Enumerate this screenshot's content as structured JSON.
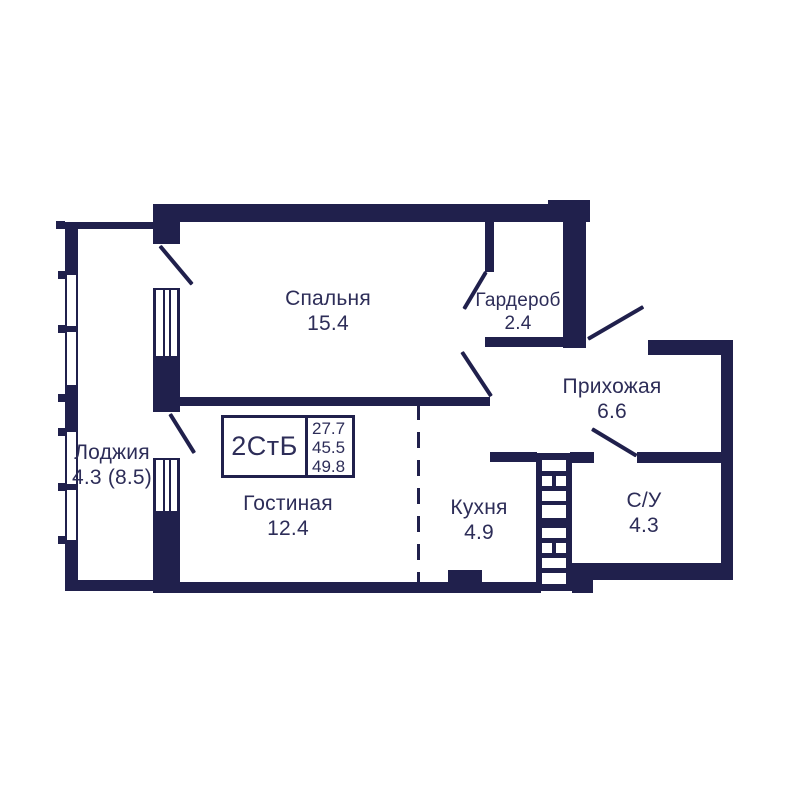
{
  "floor_plan": {
    "unit_label": "2СтБ",
    "areas": {
      "line1": "27.7",
      "line2": "45.5",
      "line3": "49.8"
    },
    "rooms": {
      "bedroom": {
        "name": "Спальня",
        "area": "15.4"
      },
      "wardrobe": {
        "name": "Гардероб",
        "area": "2.4"
      },
      "hallway": {
        "name": "Прихожая",
        "area": "6.6"
      },
      "loggia": {
        "name": "Лоджия",
        "area": "4.3 (8.5)"
      },
      "living_room": {
        "name": "Гостиная",
        "area": "12.4"
      },
      "kitchen": {
        "name": "Кухня",
        "area": "4.9"
      },
      "bathroom": {
        "name": "С/У",
        "area": "4.3"
      }
    },
    "colors": {
      "wall": "#20204c",
      "text": "#2d2d58",
      "background": "#ffffff"
    }
  }
}
